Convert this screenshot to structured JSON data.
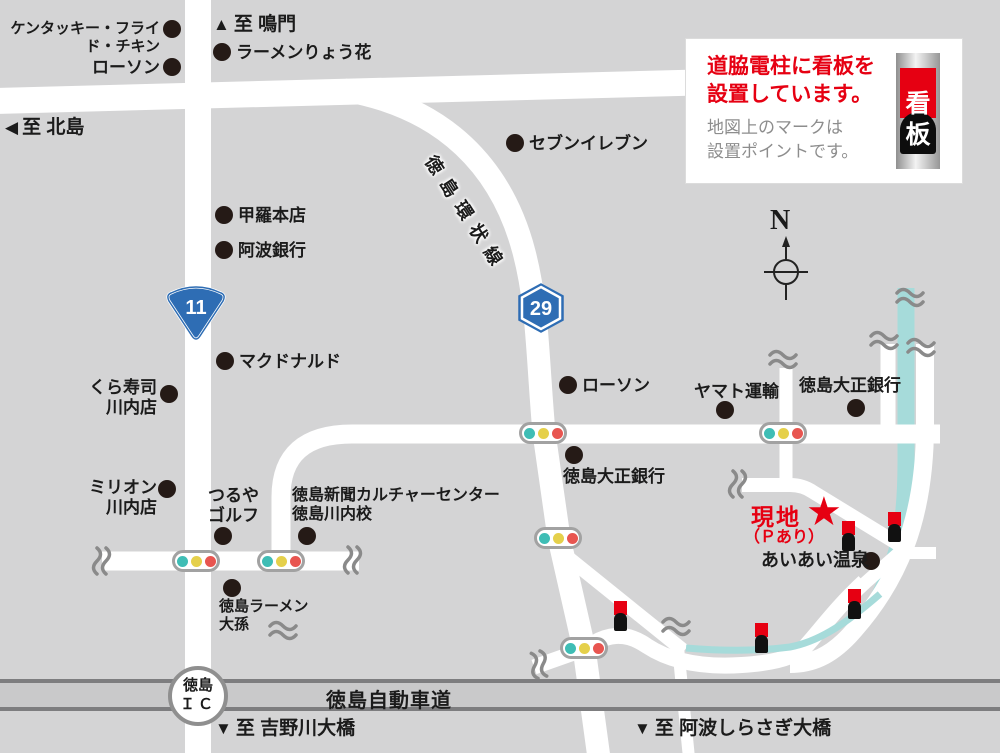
{
  "map": {
    "colors": {
      "background": "#d4d4d5",
      "road": "#ffffff",
      "river": "#a6dbda",
      "accent_red": "#e60012",
      "shield_blue": "#2e6db4",
      "expressway_fill": "#c9c9ca",
      "expressway_border": "#7d7d7f",
      "signal_teal": "#3fbdb5",
      "signal_yellow": "#e5d04b",
      "signal_red": "#e85550"
    },
    "pois": [
      {
        "label": "ケンタッキー・フライド・チキン"
      },
      {
        "label": "ローソン"
      },
      {
        "label": "ラーメンりょう花"
      },
      {
        "label": "セブンイレブン"
      },
      {
        "label": "甲羅本店"
      },
      {
        "label": "阿波銀行"
      },
      {
        "label": "マクドナルド"
      },
      {
        "label": "くら寿司\n川内店"
      },
      {
        "label": "ミリオン\n川内店"
      },
      {
        "label": "つるや\nゴルフ"
      },
      {
        "label": "徳島新聞カルチャーセンター\n徳島川内校"
      },
      {
        "label": "ローソン"
      },
      {
        "label": "ヤマト運輸"
      },
      {
        "label": "徳島大正銀行"
      },
      {
        "label": "徳島大正銀行"
      },
      {
        "label": "あいあい温泉"
      },
      {
        "label": "徳島ラーメン\n大孫"
      }
    ],
    "directions": [
      {
        "arrow": "▲",
        "label": "至 鳴門"
      },
      {
        "arrow": "◀",
        "label": "至 北島"
      },
      {
        "arrow": "▼",
        "label": "至 吉野川大橋"
      },
      {
        "arrow": "▼",
        "label": "至 阿波しらさぎ大橋"
      }
    ],
    "destination": {
      "name": "現地",
      "note": "（Ｐあり）",
      "star": "★"
    },
    "road_labels": {
      "ring_road": "徳島環状線",
      "expressway": "徳島自動車道",
      "ic_line1": "徳島",
      "ic_line2": "ＩＣ"
    },
    "route_shields": {
      "national_route": "11",
      "prefectural_route": "29"
    },
    "compass": {
      "north": "N"
    }
  },
  "legend": {
    "title": "道脇電柱に看板を\n設置しています。",
    "description": "地図上のマークは\n設置ポイントです。",
    "sign_top": "看",
    "sign_bottom": "板"
  }
}
